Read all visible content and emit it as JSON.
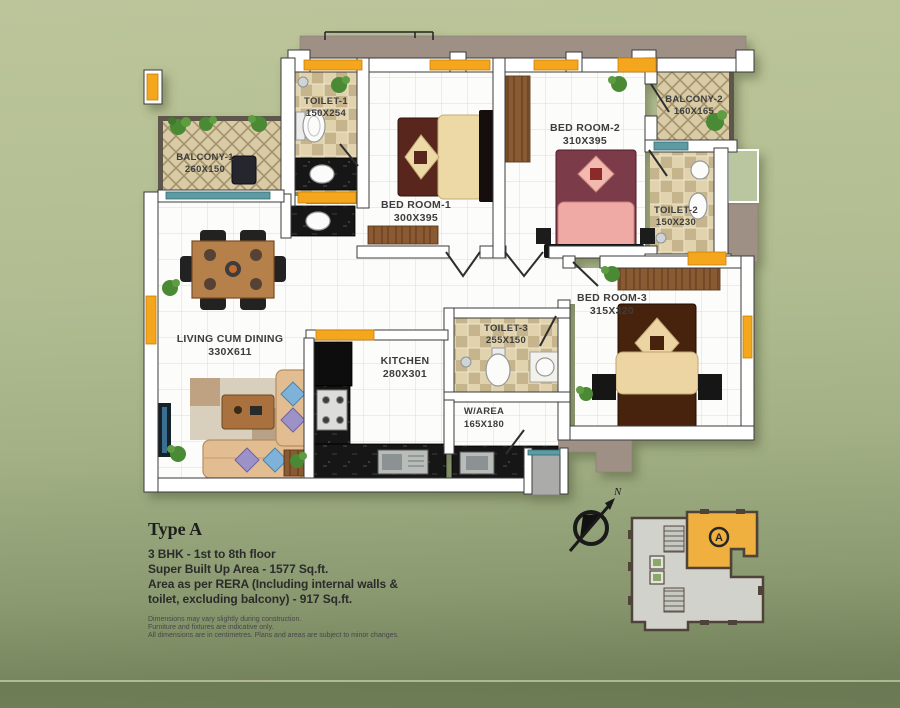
{
  "plan": {
    "rooms": {
      "balcony1": {
        "name": "BALCONY-1",
        "dims": "260X150"
      },
      "toilet1": {
        "name": "TOILET-1",
        "dims": "150X254"
      },
      "bedroom1": {
        "name": "BED ROOM-1",
        "dims": "300X395"
      },
      "bedroom2": {
        "name": "BED ROOM-2",
        "dims": "310X395"
      },
      "balcony2": {
        "name": "BALCONY-2",
        "dims": "160X165"
      },
      "toilet2": {
        "name": "TOILET-2",
        "dims": "150X230"
      },
      "bedroom3": {
        "name": "BED ROOM-3",
        "dims": "315X320"
      },
      "living": {
        "name": "LIVING CUM DINING",
        "dims": "330X611"
      },
      "kitchen": {
        "name": "KITCHEN",
        "dims": "280X301"
      },
      "toilet3": {
        "name": "TOILET-3",
        "dims": "255X150"
      },
      "warea": {
        "name": "W/AREA",
        "dims": "165X180"
      }
    },
    "compass": {
      "north": "N"
    },
    "key_plan": {
      "unit": "A"
    }
  },
  "info": {
    "type_label": "Type A",
    "line1": "3 BHK - 1st to 8th floor",
    "line2": "Super Built Up Area - 1577 Sq.ft.",
    "line3": "Area as per RERA (Including internal walls &",
    "line4": "toilet, excluding balcony) - 917 Sq.ft.",
    "note1": "Dimensions may vary slightly during construction.",
    "note2": "Furniture and fixtures are indicative only.",
    "note3": "All dimensions are in centimetres. Plans and areas are subject to minor changes."
  },
  "colors": {
    "background_green": "#aab88e",
    "accent_orange": "#f4a71b",
    "wall_white": "#ffffff",
    "exterior_taupe": "#9e9085",
    "counter_black": "#191919",
    "window_teal": "#5d9aa2",
    "keyplan_unit_orange": "#f0b040"
  }
}
